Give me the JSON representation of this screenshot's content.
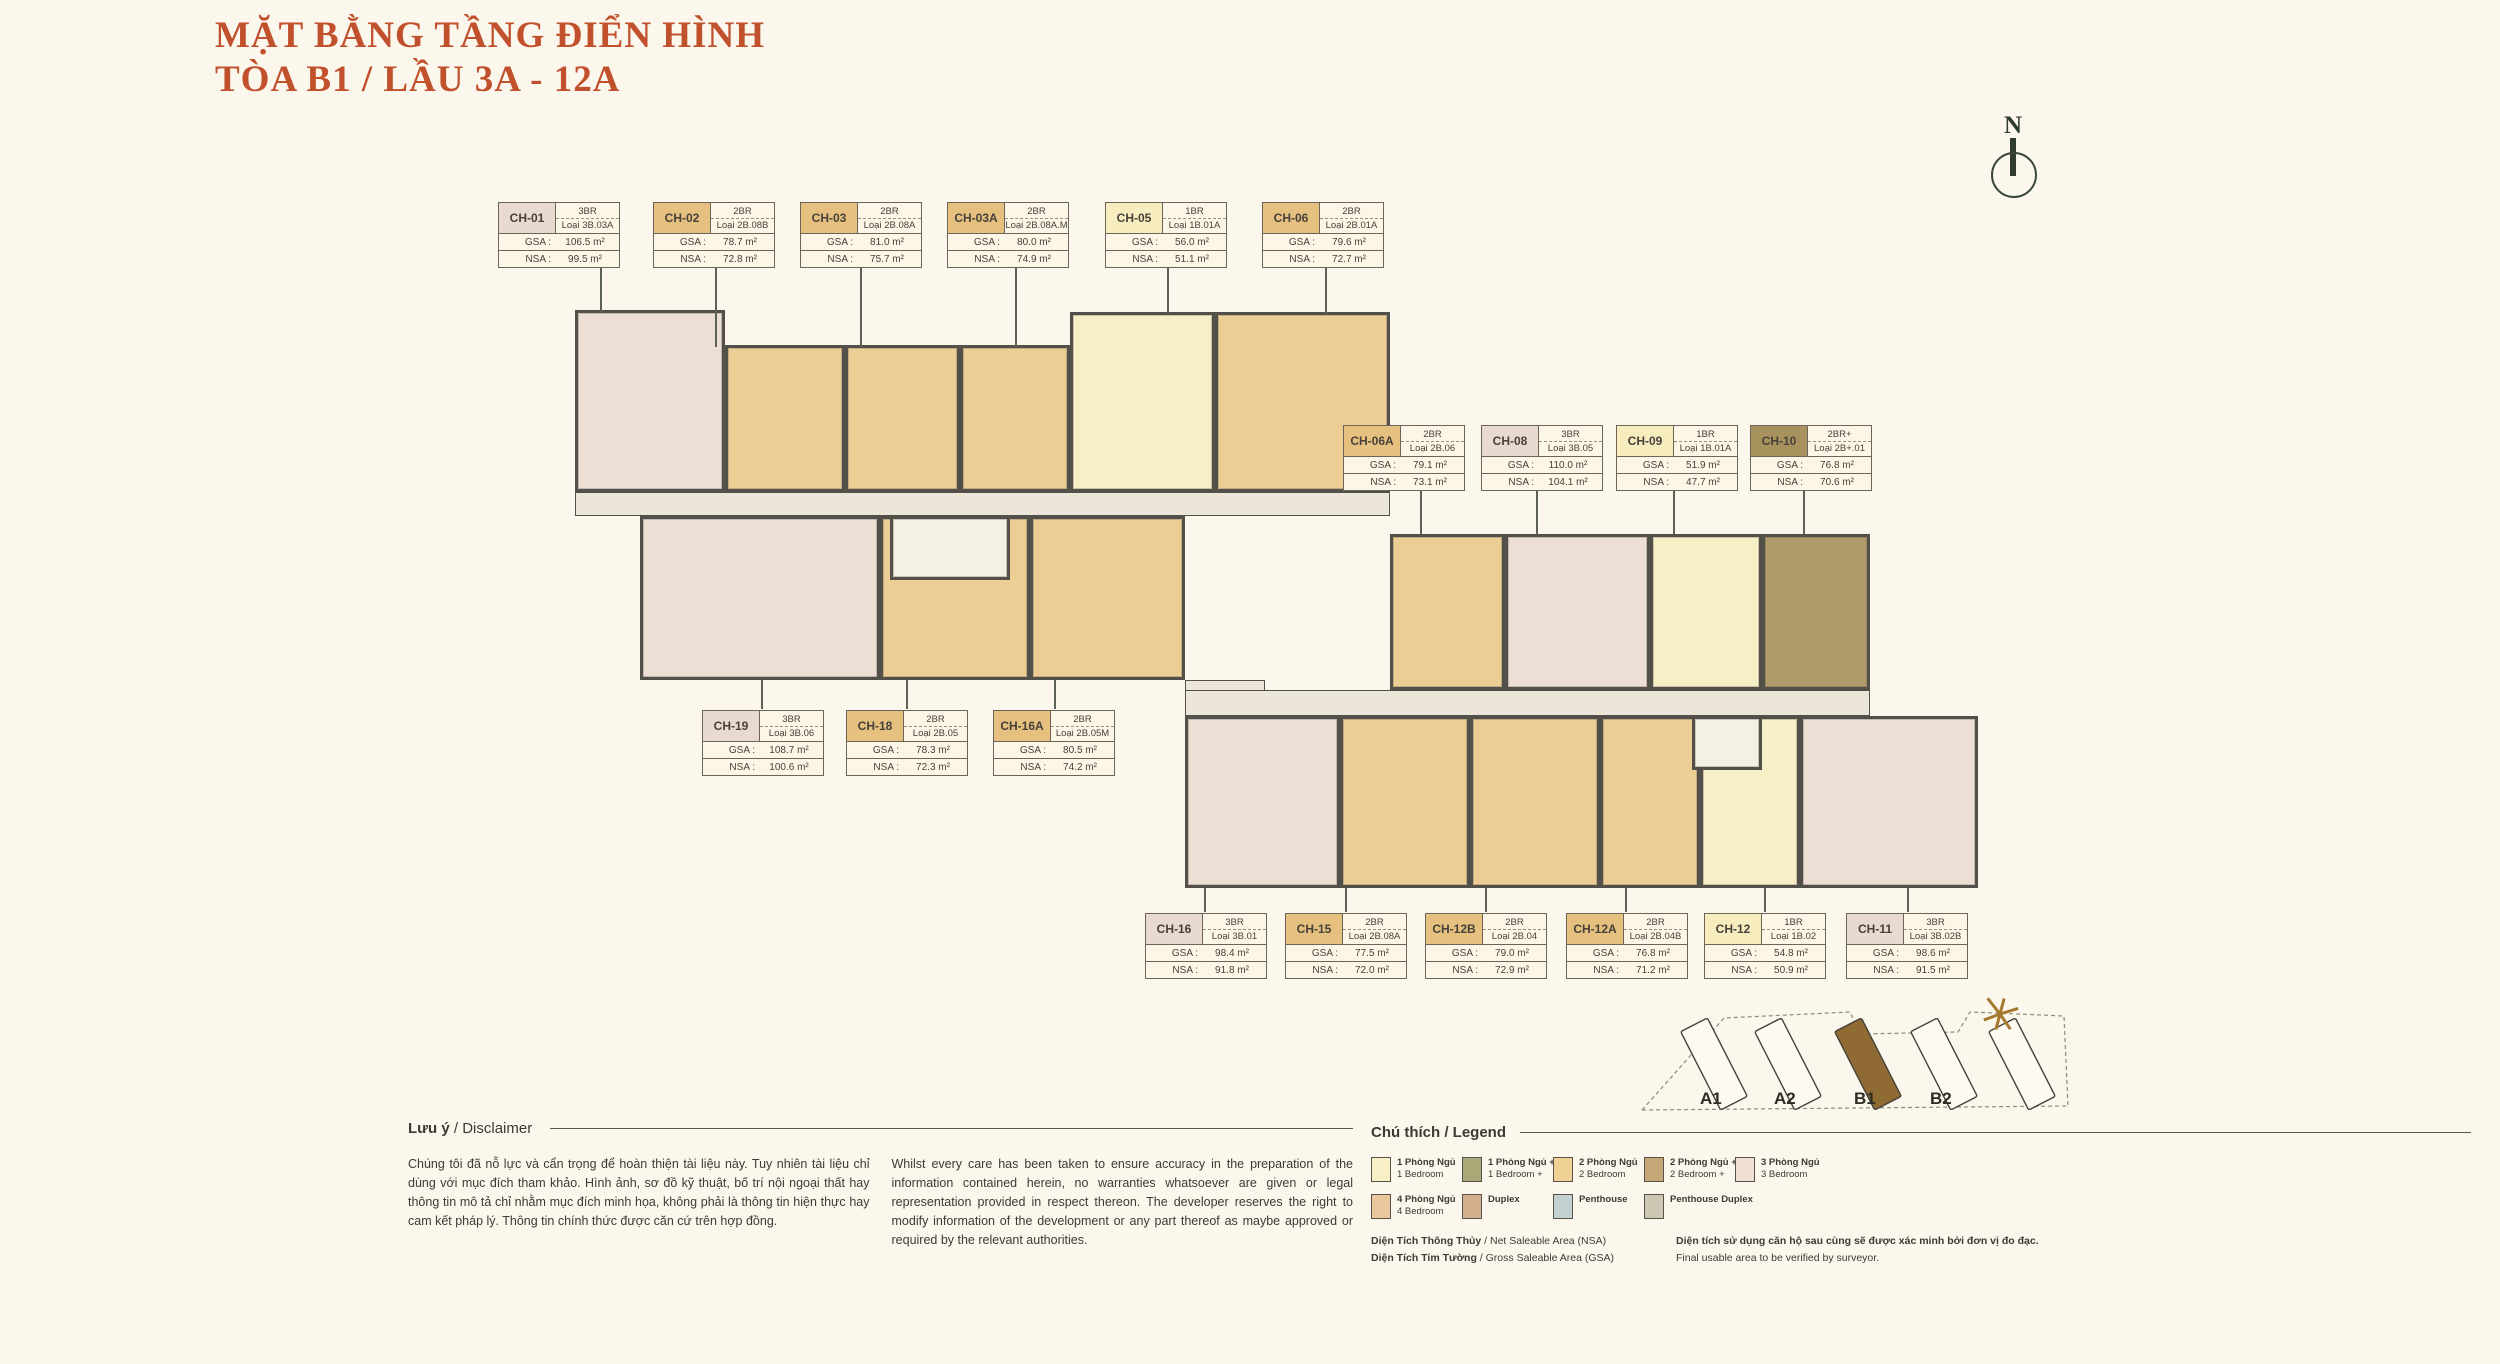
{
  "title": {
    "line1": "MẶT BẰNG TẦNG ĐIỂN HÌNH",
    "line2": "TÒA B1 / LẦU 3A - 12A"
  },
  "compass": {
    "label": "N"
  },
  "labels": {
    "gsa": "GSA :",
    "nsa": "NSA :"
  },
  "units": [
    {
      "id": "CH-01",
      "br": "3BR",
      "loai": "Loại 3B.03A",
      "gsa": "106.5 m²",
      "nsa": "99.5 m²",
      "type": "3br"
    },
    {
      "id": "CH-02",
      "br": "2BR",
      "loai": "Loại 2B.08B",
      "gsa": "78.7 m²",
      "nsa": "72.8 m²",
      "type": "2br"
    },
    {
      "id": "CH-03",
      "br": "2BR",
      "loai": "Loại 2B.08A",
      "gsa": "81.0 m²",
      "nsa": "75.7 m²",
      "type": "2br"
    },
    {
      "id": "CH-03A",
      "br": "2BR",
      "loai": "Loại 2B.08A.M",
      "gsa": "80.0 m²",
      "nsa": "74.9 m²",
      "type": "2br"
    },
    {
      "id": "CH-05",
      "br": "1BR",
      "loai": "Loại 1B.01A",
      "gsa": "56.0 m²",
      "nsa": "51.1 m²",
      "type": "1br"
    },
    {
      "id": "CH-06",
      "br": "2BR",
      "loai": "Loại 2B.01A",
      "gsa": "79.6 m²",
      "nsa": "72.7 m²",
      "type": "2br"
    },
    {
      "id": "CH-06A",
      "br": "2BR",
      "loai": "Loại 2B.06",
      "gsa": "79.1 m²",
      "nsa": "73.1 m²",
      "type": "2br"
    },
    {
      "id": "CH-08",
      "br": "3BR",
      "loai": "Loại 3B.05",
      "gsa": "110.0 m²",
      "nsa": "104.1 m²",
      "type": "3br"
    },
    {
      "id": "CH-09",
      "br": "1BR",
      "loai": "Loại 1B.01A",
      "gsa": "51.9 m²",
      "nsa": "47.7 m²",
      "type": "1br"
    },
    {
      "id": "CH-10",
      "br": "2BR+",
      "loai": "Loại 2B+.01",
      "gsa": "76.8 m²",
      "nsa": "70.6 m²",
      "type": "2brp"
    },
    {
      "id": "CH-19",
      "br": "3BR",
      "loai": "Loại 3B.06",
      "gsa": "108.7 m²",
      "nsa": "100.6 m²",
      "type": "3br"
    },
    {
      "id": "CH-18",
      "br": "2BR",
      "loai": "Loại 2B.05",
      "gsa": "78.3 m²",
      "nsa": "72.3 m²",
      "type": "2br"
    },
    {
      "id": "CH-16A",
      "br": "2BR",
      "loai": "Loại 2B.05M",
      "gsa": "80.5 m²",
      "nsa": "74.2 m²",
      "type": "2br"
    },
    {
      "id": "CH-16",
      "br": "3BR",
      "loai": "Loại 3B.01",
      "gsa": "98.4 m²",
      "nsa": "91.8 m²",
      "type": "3br"
    },
    {
      "id": "CH-15",
      "br": "2BR",
      "loai": "Loại 2B.08A",
      "gsa": "77.5 m²",
      "nsa": "72.0 m²",
      "type": "2br"
    },
    {
      "id": "CH-12B",
      "br": "2BR",
      "loai": "Loại 2B.04",
      "gsa": "79.0 m²",
      "nsa": "72.9 m²",
      "type": "2br"
    },
    {
      "id": "CH-12A",
      "br": "2BR",
      "loai": "Loại 2B.04B",
      "gsa": "76.8 m²",
      "nsa": "71.2 m²",
      "type": "2br"
    },
    {
      "id": "CH-12",
      "br": "1BR",
      "loai": "Loại 1B.02",
      "gsa": "54.8 m²",
      "nsa": "50.9 m²",
      "type": "1br"
    },
    {
      "id": "CH-11",
      "br": "3BR",
      "loai": "Loại 3B.02B",
      "gsa": "98.6 m²",
      "nsa": "91.5 m²",
      "type": "3br"
    }
  ],
  "minimap": {
    "buildings": [
      {
        "label": "A1",
        "highlight": false
      },
      {
        "label": "A2",
        "highlight": false
      },
      {
        "label": "B1",
        "highlight": true
      },
      {
        "label": "B2",
        "highlight": false
      },
      {
        "label": "",
        "highlight": false
      }
    ],
    "highlight_color": "#8F6A33"
  },
  "disclaimer": {
    "heading_bold": "Lưu ý",
    "heading_rest": " / Disclaimer",
    "vn": "Chúng tôi đã nỗ lực và cẩn trọng để hoàn thiện tài liệu này. Tuy nhiên tài liệu chỉ dùng với mục đích tham khảo. Hình ảnh, sơ đồ kỹ thuật, bố trí nội ngoại thất hay thông tin mô tả chỉ nhằm mục đích minh họa, không phải là thông tin hiện thực hay cam kết pháp lý. Thông tin chính thức được căn cứ trên hợp đồng.",
    "en": "Whilst every care has been taken to ensure accuracy in the preparation of the information contained herein, no warranties whatsoever are given or legal representation provided in respect thereon. The developer reserves the right to modify information of the development or any part thereof as maybe approved or required by the relevant authorities."
  },
  "legend": {
    "heading": "Chú thích / Legend",
    "items": [
      {
        "vn": "1 Phòng Ngủ",
        "en": "1 Bedroom",
        "color": "#F7EFC5"
      },
      {
        "vn": "1 Phòng Ngủ +",
        "en": "1 Bedroom +",
        "color": "#ABA878"
      },
      {
        "vn": "2 Phòng Ngủ",
        "en": "2 Bedroom",
        "color": "#EFD195"
      },
      {
        "vn": "2 Phòng Ngủ +",
        "en": "2 Bedroom +",
        "color": "#C4A878"
      },
      {
        "vn": "3 Phòng Ngủ",
        "en": "3 Bedroom",
        "color": "#EFE0D3"
      },
      {
        "vn": "4 Phòng Ngủ",
        "en": "4 Bedroom",
        "color": "#E9C69B"
      },
      {
        "vn": "Duplex",
        "en": "",
        "color": "#D6AF8F"
      },
      {
        "vn": "Penthouse",
        "en": "",
        "color": "#C3D0D2"
      },
      {
        "vn": "Penthouse Duplex",
        "en": "",
        "color": "#CCC6B2"
      }
    ],
    "footer": {
      "nsa_bold": "Diện Tích Thông Thủy",
      "nsa_rest": " / Net Saleable Area (NSA)",
      "gsa_bold": "Diện Tích Tim Tường",
      "gsa_rest": " / Gross Saleable Area (GSA)",
      "note_vn": "Diện tích sử dụng căn hộ sau cùng sẽ được xác minh bởi đơn vị đo đạc.",
      "note_en": "Final usable area to be verified by surveyor."
    }
  }
}
